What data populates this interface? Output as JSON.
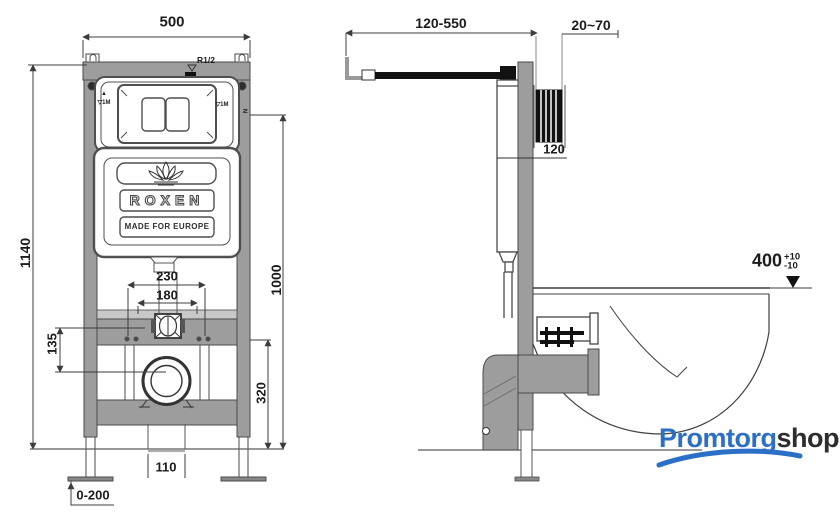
{
  "front": {
    "dim_width": "500",
    "dim_height": "1140",
    "dim_230": "230",
    "dim_180": "180",
    "dim_135": "135",
    "dim_1000": "1000",
    "dim_320": "320",
    "dim_110": "110",
    "dim_feet": "0-200",
    "inlet_label": "R1/2",
    "level_icon": "▲",
    "level_left": "▽1M",
    "level_right": "▽1M",
    "n_mark": "N",
    "brand": "ROXEN",
    "tagline": "MADE FOR EUROPE"
  },
  "side": {
    "dim_supply": "120-550",
    "dim_wall": "20~70",
    "dim_depth": "120",
    "dim_rim": "400",
    "dim_rim_plus": "+10",
    "dim_rim_minus": "-10"
  },
  "logo": {
    "part1": "Promtorg",
    "part2": "shop"
  },
  "colors": {
    "line": "#3c3c3c",
    "frame_gray": "#9d9d9d",
    "black": "#111111",
    "logo_blue": "#2b6fc7",
    "logo_dark": "#2d2d2d"
  }
}
